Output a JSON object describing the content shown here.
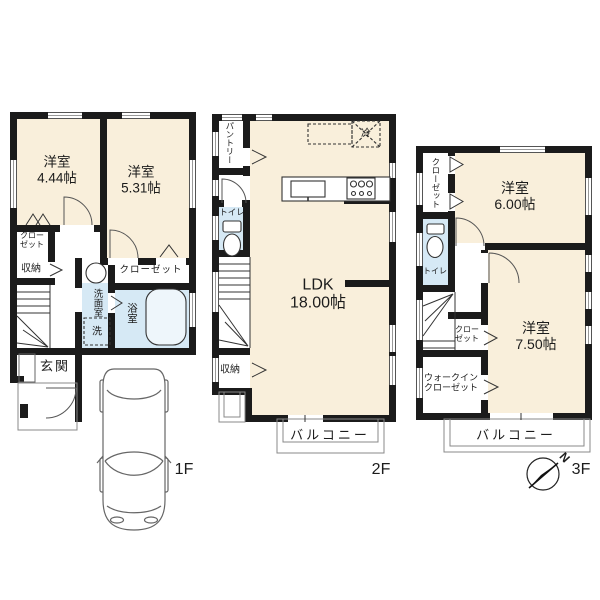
{
  "floor1": {
    "label": "1F",
    "bedroom1": {
      "name": "洋室",
      "size": "4.44帖"
    },
    "bedroom2": {
      "name": "洋室",
      "size": "5.31帖"
    },
    "closet_small": {
      "line1": "クロー",
      "line2": "ゼット"
    },
    "storage": "収納",
    "washroom": "洗面室",
    "washer": "洗",
    "bathroom": "浴室",
    "closet": "クローゼット",
    "entrance": "玄関"
  },
  "floor2": {
    "label": "2F",
    "pantry": "パントリー",
    "toilet": "トイレ",
    "fridge": "冷",
    "ldk": {
      "name": "LDK",
      "size": "18.00帖"
    },
    "storage": "収納",
    "balcony": "バルコニー"
  },
  "floor3": {
    "label": "3F",
    "closet_left": "クローゼット",
    "toilet": "トイレ",
    "bedroom1": {
      "name": "洋室",
      "size": "6.00帖"
    },
    "bedroom2": {
      "name": "洋室",
      "size": "7.50帖"
    },
    "closet_small": {
      "line1": "クロー",
      "line2": "ゼット"
    },
    "walk_in_closet": {
      "line1": "ウォークイン",
      "line2": "クローゼット"
    },
    "balcony": "バルコニー"
  },
  "compass": {
    "north": "N"
  },
  "colors": {
    "room_fill": "#F9EFDB",
    "wet_fill": "#D6E9F5",
    "wall": "#1B1B1B"
  }
}
